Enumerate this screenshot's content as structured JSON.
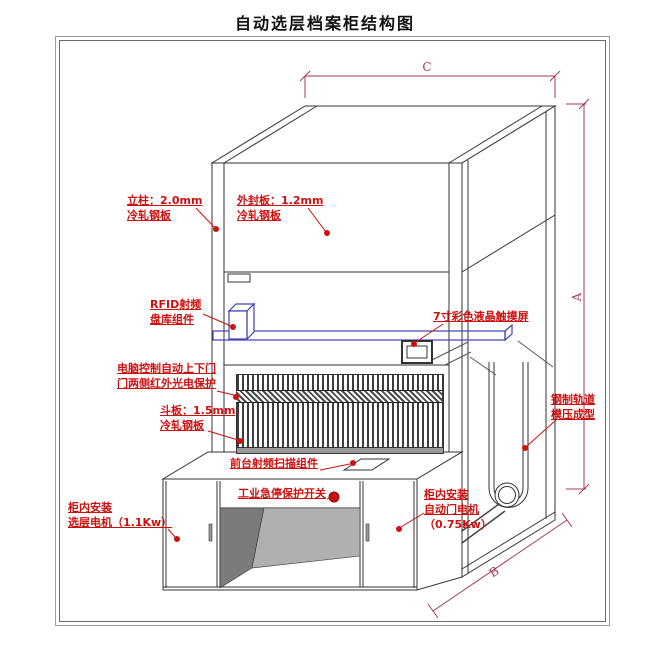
{
  "title": "自动选层档案柜结构图",
  "annotations": {
    "lizhu": {
      "lines": [
        "立柱：2.0mm",
        "冷轧钢板"
      ]
    },
    "waifengban": {
      "lines": [
        "外封板：1.2mm",
        "冷轧钢板"
      ]
    },
    "rfid": {
      "lines": [
        "RFID射频",
        "盘库组件"
      ]
    },
    "touchscreen": {
      "lines": [
        "7寸彩色液晶触摸屏"
      ]
    },
    "computer_door": {
      "lines": [
        "电脑控制自动上下门",
        "门两侧红外光电保护"
      ]
    },
    "douban": {
      "lines": [
        "斗板：1.5mm",
        "冷轧钢板"
      ]
    },
    "rail_track": {
      "lines": [
        "钢制轨道",
        "模压成型"
      ]
    },
    "front_scanner": {
      "lines": [
        "前台射频扫描组件"
      ]
    },
    "estop": {
      "lines": [
        "工业急停保护开关"
      ]
    },
    "layer_motor": {
      "lines": [
        "柜内安装",
        "选层电机（1.1Kw）"
      ]
    },
    "door_motor": {
      "lines": [
        "柜内安装",
        "自动门电机",
        "（0.75Kw）"
      ]
    }
  },
  "dimensions": {
    "width_label": "C",
    "height_label": "A",
    "depth_label": "B"
  },
  "colors": {
    "annotation_red": "#cc1111",
    "dimension_red": "#a43a50",
    "component_blue": "#4040b8",
    "line_dark": "#333333"
  }
}
